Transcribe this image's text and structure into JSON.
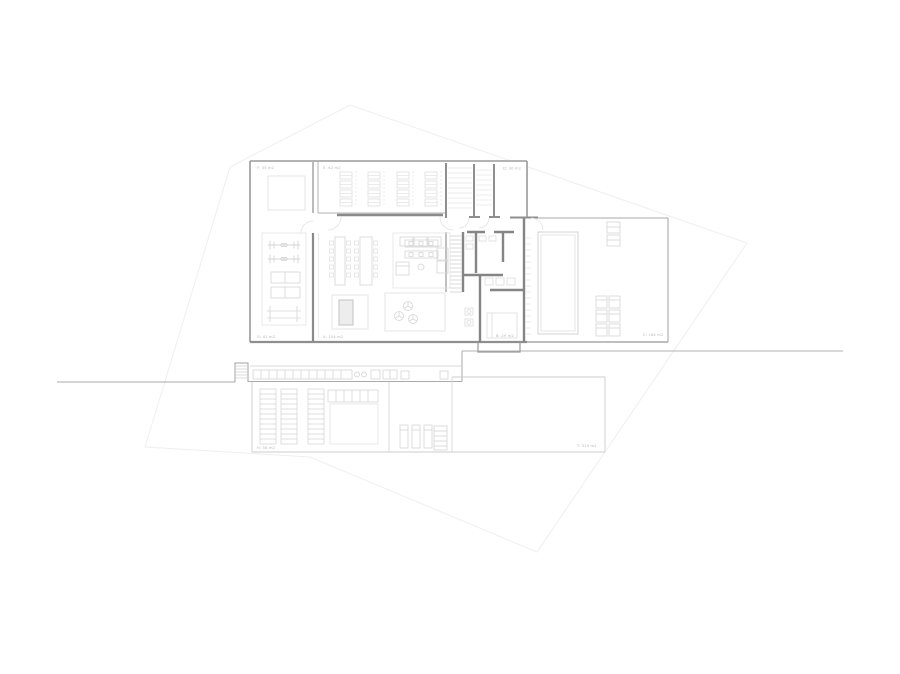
{
  "drawing": {
    "kind": "architectural-floor-plan",
    "background": "#ffffff"
  },
  "colors": {
    "site_boundary": "#efefef",
    "terrain_line": "#aaaaaa",
    "outer_wall": "#9a9a9a",
    "core_wall": "#858585",
    "light_wall": "#cccccc",
    "furniture": "#d9d9d9",
    "hatch": "#e4e4e4",
    "label_text": "#b5b5b5",
    "pool_inner": "#e0e0e0",
    "table_fill": "#ededed"
  },
  "area_labels": [
    {
      "room": "room-top-left",
      "text": "F: 35 m2"
    },
    {
      "room": "room-racks",
      "text": "E: 62 m2"
    },
    {
      "room": "room-entry",
      "text": "D: 30 m2"
    },
    {
      "room": "room-gym",
      "text": "G: 41 m2"
    },
    {
      "room": "room-living",
      "text": "A: 154 m2"
    },
    {
      "room": "room-suite",
      "text": "B: 29 m2"
    },
    {
      "room": "terrace-pool",
      "text": "C: 164 m2"
    },
    {
      "room": "lower-left-room",
      "text": "H: 58 m2"
    },
    {
      "room": "lower-right-room",
      "text": "T: 310 m2"
    }
  ]
}
